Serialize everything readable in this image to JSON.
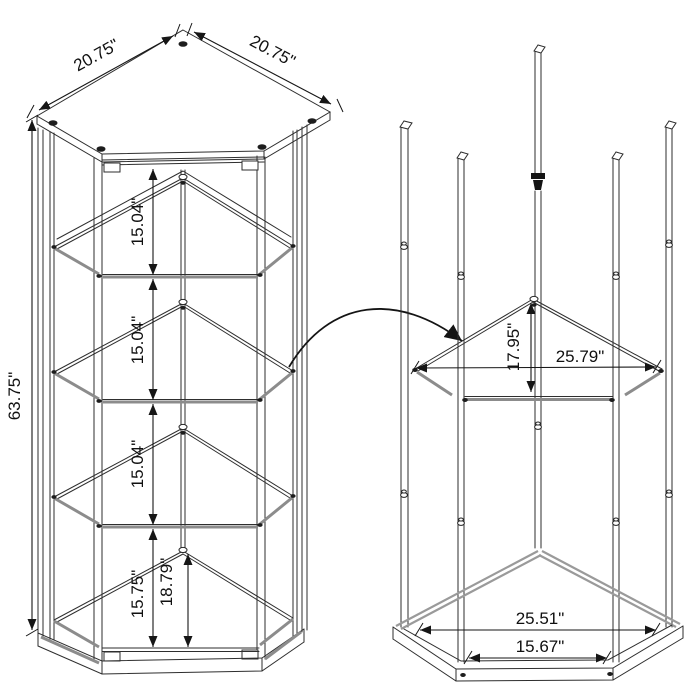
{
  "dimensions": {
    "assembled_view": {
      "top_edge_left": "20.75\"",
      "top_edge_right": "20.75\"",
      "overall_height": "63.75\"",
      "shelf_gap_top": "15.04\"",
      "shelf_gap_middle": "15.04\"",
      "shelf_gap_lower": "15.04\"",
      "bottom_section_height": "15.75\"",
      "base_interior_depth": "18.79\""
    },
    "frame_view": {
      "shelf_depth": "17.95\"",
      "shelf_span": "25.79\"",
      "base_span": "25.51\"",
      "base_front_edge": "15.67\""
    }
  }
}
